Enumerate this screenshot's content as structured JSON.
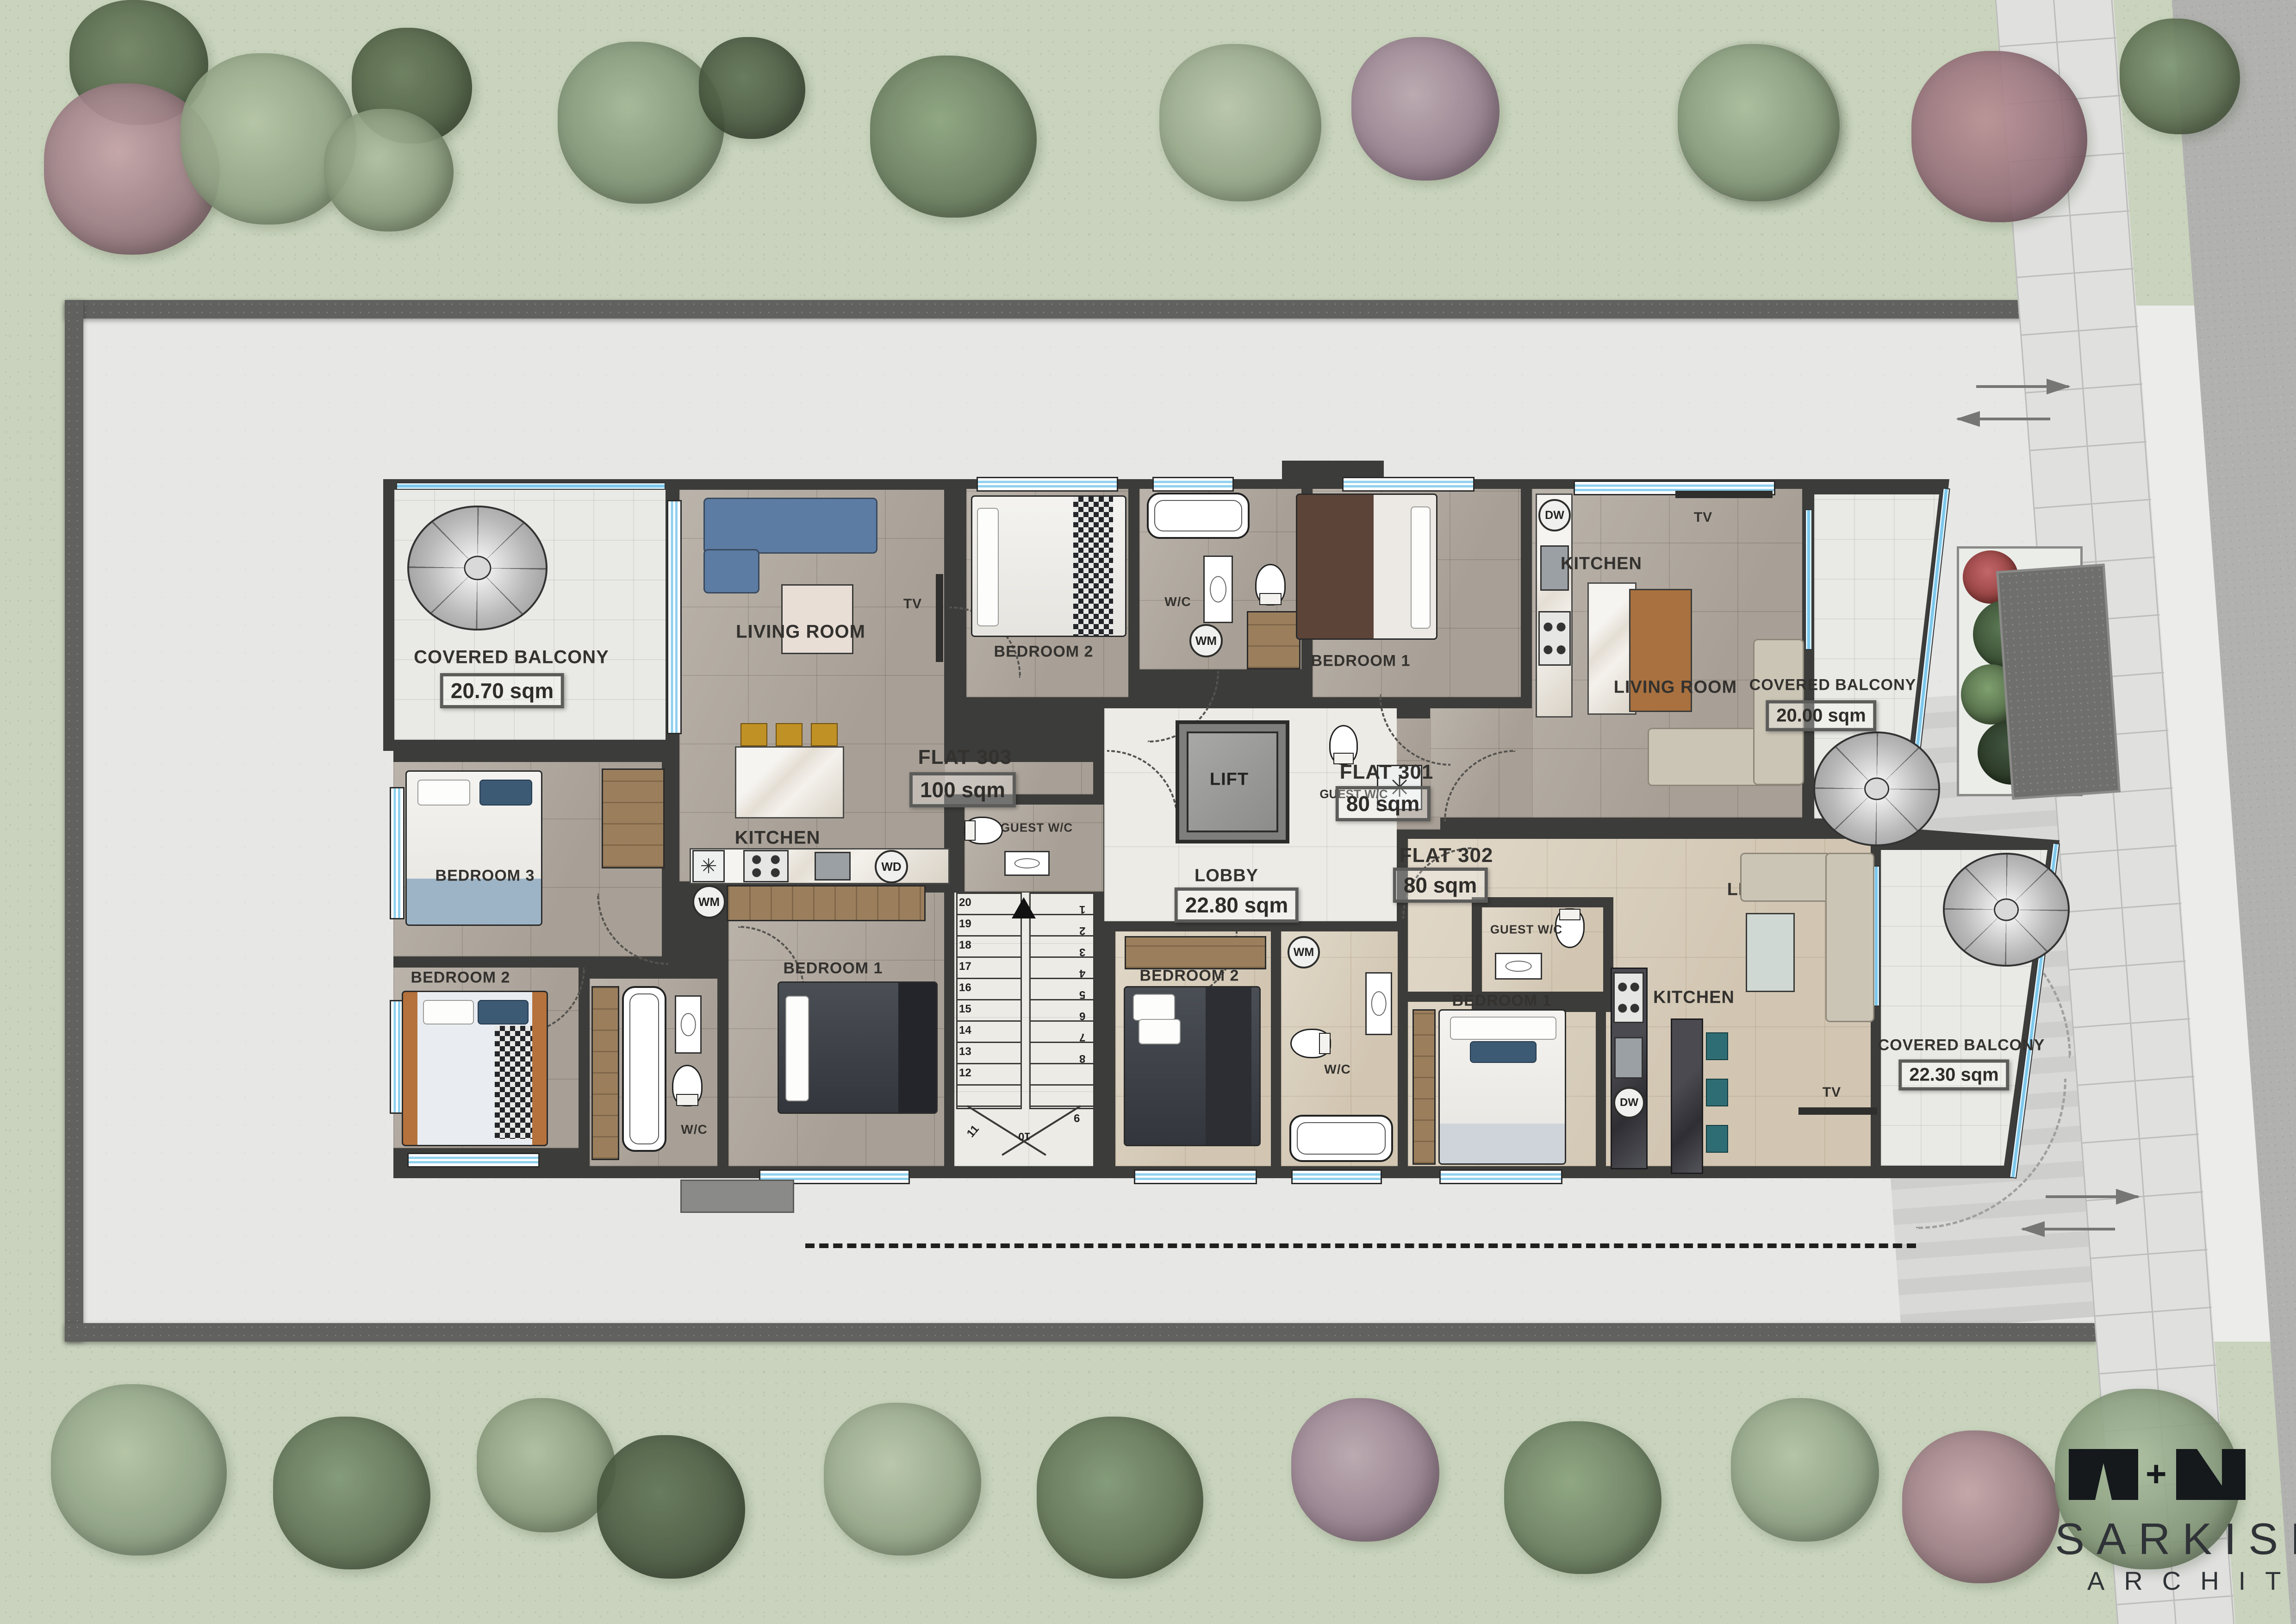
{
  "branding": {
    "firm_name": "SARKISIAN",
    "firm_subtitle": "ARCHITECTS",
    "logo_plus": "+"
  },
  "palette": {
    "wall_dark": "#3c3c3a",
    "floor_gray": "#b3aba1",
    "floor_beige": "#dcd2c0",
    "glass_blue": "#7cc8ec",
    "grass_green": "#c9d3bd"
  },
  "plan": {
    "core": {
      "lift": "LIFT",
      "lobby": "LOBBY",
      "lobby_area": "22.80 sqm"
    },
    "appliances": {
      "washing_machine": "WM",
      "dishwasher": "DW",
      "washer_dryer": "WD",
      "shower_symbol": "✳"
    },
    "stairs": {
      "step_numbers": [
        "1",
        "2",
        "3",
        "4",
        "5",
        "6",
        "7",
        "8",
        "9",
        "10",
        "11",
        "12",
        "13",
        "14",
        "15",
        "16",
        "17",
        "18",
        "19",
        "20"
      ]
    },
    "flat303": {
      "name": "FLAT 303",
      "area": "100 sqm",
      "living_room": "LIVING ROOM",
      "kitchen": "KITCHEN",
      "bedroom1": "BEDROOM 1",
      "bedroom2": "BEDROOM 2",
      "bedroom3": "BEDROOM 3",
      "bathroom": "W/C",
      "guest_wc": "GUEST W/C",
      "tv": "TV",
      "balcony_title": "COVERED BALCONY",
      "balcony_area": "20.70 sqm"
    },
    "flat301": {
      "name": "FLAT 301",
      "area": "80 sqm",
      "living_room": "LIVING ROOM",
      "kitchen": "KITCHEN",
      "bedroom1": "BEDROOM 1",
      "bedroom2": "BEDROOM 2",
      "bathroom": "W/C",
      "guest_wc": "GUEST W/C",
      "tv": "TV",
      "balcony_title": "COVERED BALCONY",
      "balcony_area": "20.00 sqm"
    },
    "flat302": {
      "name": "FLAT 302",
      "area": "80 sqm",
      "living_room": "LIVING ROOM",
      "kitchen": "KITCHEN",
      "bedroom1": "BEDROOM 1",
      "bedroom2": "BEDROOM 2",
      "bathroom": "W/C",
      "guest_wc": "GUEST W/C",
      "tv": "TV",
      "balcony_title": "COVERED BALCONY",
      "balcony_area": "22.30 sqm"
    }
  }
}
